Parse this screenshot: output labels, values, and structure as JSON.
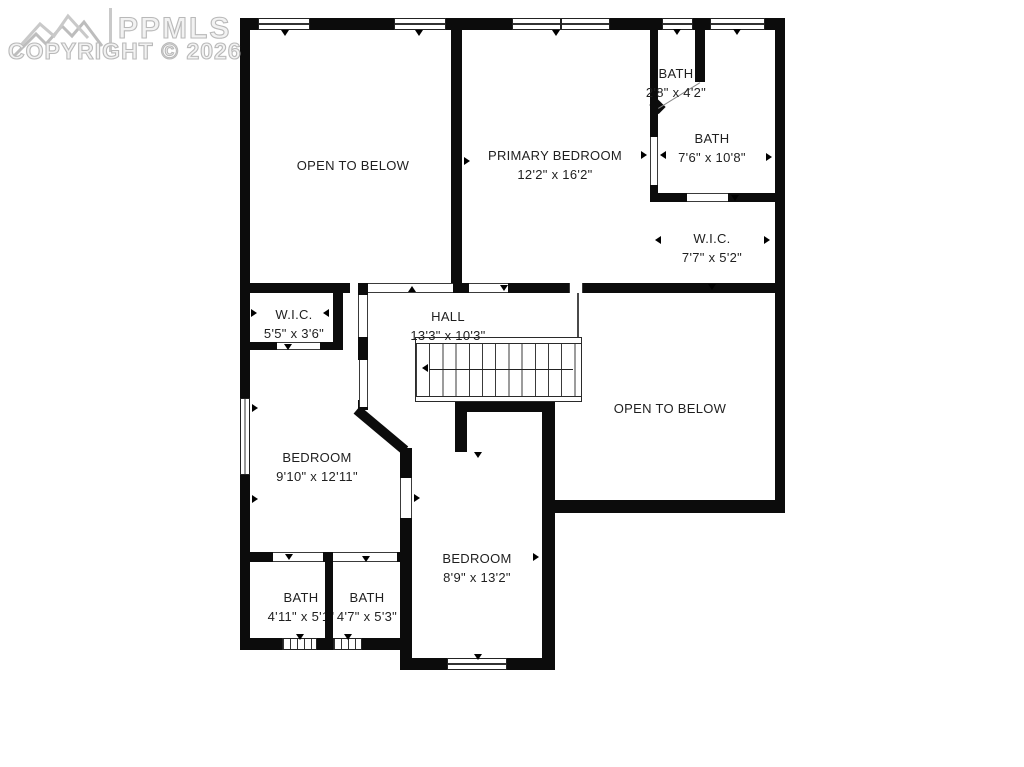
{
  "watermark": {
    "brand": "PPMLS",
    "copyright": "COPYRIGHT © 2026",
    "logo": "mountain-range-logo"
  },
  "floorplan": {
    "rooms": [
      {
        "label": "OPEN TO BELOW",
        "dims": ""
      },
      {
        "label": "PRIMARY BEDROOM",
        "dims": "12'2\" x 16'2\""
      },
      {
        "label": "BATH",
        "dims": "2'8\" x 4'2\""
      },
      {
        "label": "BATH",
        "dims": "7'6\" x 10'8\""
      },
      {
        "label": "W.I.C.",
        "dims": "7'7\" x 5'2\""
      },
      {
        "label": "W.I.C.",
        "dims": "5'5\" x 3'6\""
      },
      {
        "label": "HALL",
        "dims": "13'3\" x 10'3\""
      },
      {
        "label": "OPEN TO BELOW",
        "dims": ""
      },
      {
        "label": "BEDROOM",
        "dims": "9'10\" x 12'11\""
      },
      {
        "label": "BEDROOM",
        "dims": "8'9\" x 13'2\""
      },
      {
        "label": "BATH",
        "dims": "4'11\" x 5'1\""
      },
      {
        "label": "BATH",
        "dims": "4'7\" x 5'3\""
      }
    ],
    "has_staircase": true
  },
  "colors": {
    "wall": "#0c0c0c",
    "background": "#ffffff",
    "watermark": "#bdbdbd"
  }
}
